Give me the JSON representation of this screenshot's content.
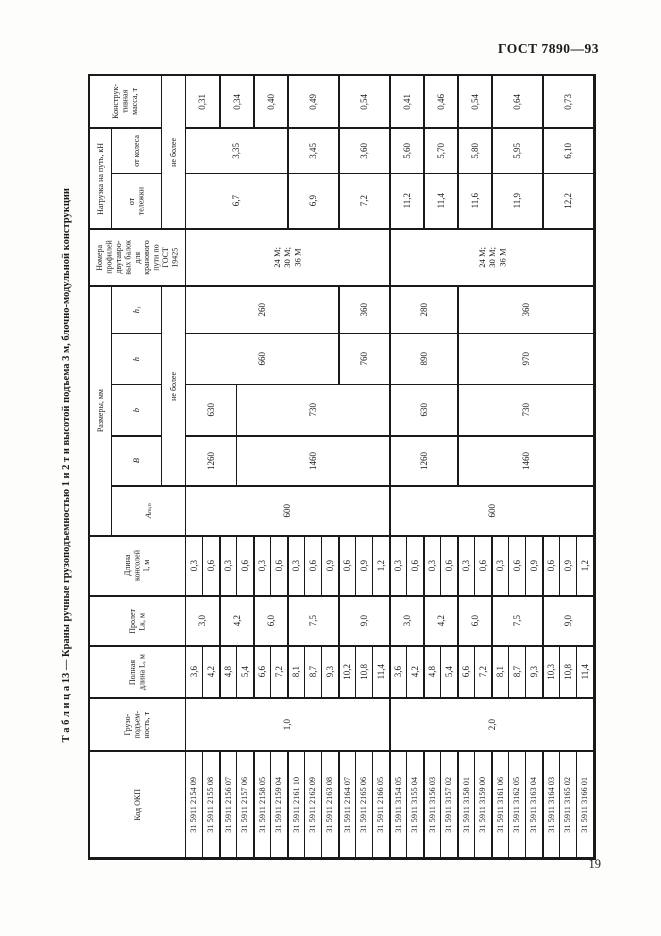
{
  "page": {
    "header": "ГОСТ 7890—93",
    "page_number": "19",
    "table_title": "Т а б л и ц а  13 — Краны ручные грузоподъемностью 1 и 2 т и высотой подъема 3 м, блочно-модульной конструкции"
  },
  "table": {
    "thick_bottom_rows": [
      1,
      3,
      4,
      7,
      8,
      9,
      10,
      11,
      12,
      13
    ],
    "thick_left_cols": [
      6,
      8,
      10,
      13,
      16,
      18,
      20,
      22,
      25
    ],
    "header_cells": [
      {
        "r": 1,
        "c": 1,
        "cs": 2,
        "t": "Конструк-\nтивная\nмасса, т",
        "n": "header-mass",
        "cls": "hdr"
      },
      {
        "r": 1,
        "c": 3,
        "rs": 3,
        "t": "не более",
        "n": "header-ne-bolee-load",
        "cls": "hdr"
      },
      {
        "r": 2,
        "c": 1,
        "rs": 2,
        "t": "Нагрузка на путь, кН",
        "n": "header-load-on-track",
        "cls": "hdr"
      },
      {
        "r": 2,
        "c": 2,
        "t": "от колеса",
        "n": "header-from-wheel",
        "cls": "hdr"
      },
      {
        "r": 3,
        "c": 2,
        "t": "от\nтележки",
        "n": "header-from-trolley",
        "cls": "hdr"
      },
      {
        "r": 4,
        "c": 1,
        "cs": 3,
        "t": "Номера\nпрофилей\nдвутавро-\nвых балок\nдля\nкранового\nпути по\nГОСТ\n19425",
        "n": "header-beam-profiles",
        "cls": "hdr"
      },
      {
        "r": 5,
        "c": 1,
        "rs": 5,
        "t": "Размеры, мм",
        "n": "header-dimensions",
        "cls": "hdr"
      },
      {
        "r": 5,
        "c": 2,
        "t": "h₁",
        "n": "header-h1",
        "cls": "it"
      },
      {
        "r": 6,
        "c": 2,
        "t": "h",
        "n": "header-h",
        "cls": "it"
      },
      {
        "r": 7,
        "c": 2,
        "t": "b",
        "n": "header-b",
        "cls": "it"
      },
      {
        "r": 8,
        "c": 2,
        "t": "B",
        "n": "header-B",
        "cls": "it"
      },
      {
        "r": 5,
        "c": 3,
        "rs": 4,
        "t": "не более",
        "n": "header-ne-bolee-dim",
        "cls": "hdr"
      },
      {
        "r": 9,
        "c": 2,
        "cs": 2,
        "t": "Aₘᵢₙ",
        "n": "header-amin",
        "cls": "it"
      },
      {
        "r": 10,
        "c": 1,
        "cs": 3,
        "t": "Длина\nконсолей\nl, м",
        "n": "header-console-length",
        "cls": "hdr"
      },
      {
        "r": 11,
        "c": 1,
        "cs": 3,
        "t": "Пролет\nLк, м",
        "n": "header-span",
        "cls": "hdr"
      },
      {
        "r": 12,
        "c": 1,
        "cs": 3,
        "t": "Полная\nдлина L, м",
        "n": "header-full-length",
        "cls": "hdr"
      },
      {
        "r": 13,
        "c": 1,
        "cs": 3,
        "t": "Грузо-\nподъем-\nность, т",
        "n": "header-capacity",
        "cls": "hdr"
      },
      {
        "r": 14,
        "c": 1,
        "cs": 3,
        "t": "Код ОКП",
        "n": "header-okp-code",
        "cls": "hdr"
      }
    ],
    "merged_cells": [
      {
        "r": 1,
        "c": 4,
        "cs": 2,
        "t": "0,31",
        "n": "mass-value-cell"
      },
      {
        "r": 1,
        "c": 6,
        "cs": 2,
        "t": "0,34",
        "n": "mass-value-cell"
      },
      {
        "r": 1,
        "c": 8,
        "cs": 2,
        "t": "0,40",
        "n": "mass-value-cell"
      },
      {
        "r": 1,
        "c": 10,
        "cs": 3,
        "t": "0,49",
        "n": "mass-value-cell"
      },
      {
        "r": 1,
        "c": 13,
        "cs": 3,
        "t": "0,54",
        "n": "mass-value-cell"
      },
      {
        "r": 1,
        "c": 16,
        "cs": 2,
        "t": "0,41",
        "n": "mass-value-cell"
      },
      {
        "r": 1,
        "c": 18,
        "cs": 2,
        "t": "0,46",
        "n": "mass-value-cell"
      },
      {
        "r": 1,
        "c": 20,
        "cs": 2,
        "t": "0,54",
        "n": "mass-value-cell"
      },
      {
        "r": 1,
        "c": 22,
        "cs": 3,
        "t": "0,64",
        "n": "mass-value-cell"
      },
      {
        "r": 1,
        "c": 25,
        "cs": 3,
        "t": "0,73",
        "n": "mass-value-cell"
      },
      {
        "r": 2,
        "c": 4,
        "cs": 6,
        "t": "3,35",
        "n": "wheel-load-cell"
      },
      {
        "r": 2,
        "c": 10,
        "cs": 3,
        "t": "3,45",
        "n": "wheel-load-cell"
      },
      {
        "r": 2,
        "c": 13,
        "cs": 3,
        "t": "3,60",
        "n": "wheel-load-cell"
      },
      {
        "r": 2,
        "c": 16,
        "cs": 2,
        "t": "5,60",
        "n": "wheel-load-cell"
      },
      {
        "r": 2,
        "c": 18,
        "cs": 2,
        "t": "5,70",
        "n": "wheel-load-cell"
      },
      {
        "r": 2,
        "c": 20,
        "cs": 2,
        "t": "5,80",
        "n": "wheel-load-cell"
      },
      {
        "r": 2,
        "c": 22,
        "cs": 3,
        "t": "5,95",
        "n": "wheel-load-cell"
      },
      {
        "r": 2,
        "c": 25,
        "cs": 3,
        "t": "6,10",
        "n": "wheel-load-cell"
      },
      {
        "r": 3,
        "c": 4,
        "cs": 6,
        "t": "6,7",
        "n": "trolley-load-cell"
      },
      {
        "r": 3,
        "c": 10,
        "cs": 3,
        "t": "6,9",
        "n": "trolley-load-cell"
      },
      {
        "r": 3,
        "c": 13,
        "cs": 3,
        "t": "7,2",
        "n": "trolley-load-cell"
      },
      {
        "r": 3,
        "c": 16,
        "cs": 2,
        "t": "11,2",
        "n": "trolley-load-cell"
      },
      {
        "r": 3,
        "c": 18,
        "cs": 2,
        "t": "11,4",
        "n": "trolley-load-cell"
      },
      {
        "r": 3,
        "c": 20,
        "cs": 2,
        "t": "11,6",
        "n": "trolley-load-cell"
      },
      {
        "r": 3,
        "c": 22,
        "cs": 3,
        "t": "11,9",
        "n": "trolley-load-cell"
      },
      {
        "r": 3,
        "c": 25,
        "cs": 3,
        "t": "12,2",
        "n": "trolley-load-cell"
      },
      {
        "r": 4,
        "c": 4,
        "cs": 12,
        "t": "24 М;\n30 М;\n36 М",
        "n": "profile-numbers-cell",
        "cls": "prof"
      },
      {
        "r": 4,
        "c": 16,
        "cs": 12,
        "t": "24 М;\n30 М;\n36 М",
        "n": "profile-numbers-cell",
        "cls": "prof"
      },
      {
        "r": 5,
        "c": 4,
        "cs": 9,
        "t": "260",
        "n": "h1-value-cell"
      },
      {
        "r": 5,
        "c": 13,
        "cs": 3,
        "t": "360",
        "n": "h1-value-cell"
      },
      {
        "r": 5,
        "c": 16,
        "cs": 4,
        "t": "280",
        "n": "h1-value-cell"
      },
      {
        "r": 5,
        "c": 20,
        "cs": 8,
        "t": "360",
        "n": "h1-value-cell"
      },
      {
        "r": 6,
        "c": 4,
        "cs": 9,
        "t": "660",
        "n": "h-value-cell"
      },
      {
        "r": 6,
        "c": 13,
        "cs": 3,
        "t": "760",
        "n": "h-value-cell"
      },
      {
        "r": 6,
        "c": 16,
        "cs": 4,
        "t": "890",
        "n": "h-value-cell"
      },
      {
        "r": 6,
        "c": 20,
        "cs": 8,
        "t": "970",
        "n": "h-value-cell"
      },
      {
        "r": 7,
        "c": 4,
        "cs": 3,
        "t": "630",
        "n": "b-value-cell"
      },
      {
        "r": 7,
        "c": 7,
        "cs": 9,
        "t": "730",
        "n": "b-value-cell"
      },
      {
        "r": 7,
        "c": 16,
        "cs": 4,
        "t": "630",
        "n": "b-value-cell"
      },
      {
        "r": 7,
        "c": 20,
        "cs": 8,
        "t": "730",
        "n": "b-value-cell"
      },
      {
        "r": 8,
        "c": 4,
        "cs": 3,
        "t": "1260",
        "n": "B-value-cell"
      },
      {
        "r": 8,
        "c": 7,
        "cs": 9,
        "t": "1460",
        "n": "B-value-cell"
      },
      {
        "r": 8,
        "c": 16,
        "cs": 4,
        "t": "1260",
        "n": "B-value-cell"
      },
      {
        "r": 8,
        "c": 20,
        "cs": 8,
        "t": "1460",
        "n": "B-value-cell"
      },
      {
        "r": 9,
        "c": 4,
        "cs": 12,
        "t": "600",
        "n": "amin-value-cell"
      },
      {
        "r": 9,
        "c": 16,
        "cs": 12,
        "t": "600",
        "n": "amin-value-cell"
      },
      {
        "r": 11,
        "c": 4,
        "cs": 2,
        "t": "3,0",
        "n": "span-value-cell"
      },
      {
        "r": 11,
        "c": 6,
        "cs": 2,
        "t": "4,2",
        "n": "span-value-cell"
      },
      {
        "r": 11,
        "c": 8,
        "cs": 2,
        "t": "6,0",
        "n": "span-value-cell"
      },
      {
        "r": 11,
        "c": 10,
        "cs": 3,
        "t": "7,5",
        "n": "span-value-cell"
      },
      {
        "r": 11,
        "c": 13,
        "cs": 3,
        "t": "9,0",
        "n": "span-value-cell"
      },
      {
        "r": 11,
        "c": 16,
        "cs": 2,
        "t": "3,0",
        "n": "span-value-cell"
      },
      {
        "r": 11,
        "c": 18,
        "cs": 2,
        "t": "4,2",
        "n": "span-value-cell"
      },
      {
        "r": 11,
        "c": 20,
        "cs": 2,
        "t": "6,0",
        "n": "span-value-cell"
      },
      {
        "r": 11,
        "c": 22,
        "cs": 3,
        "t": "7,5",
        "n": "span-value-cell"
      },
      {
        "r": 11,
        "c": 25,
        "cs": 3,
        "t": "9,0",
        "n": "span-value-cell"
      },
      {
        "r": 13,
        "c": 4,
        "cs": 12,
        "t": "1,0",
        "n": "capacity-value-cell"
      },
      {
        "r": 13,
        "c": 16,
        "cs": 12,
        "t": "2,0",
        "n": "capacity-value-cell"
      }
    ],
    "simple_rows": [
      {
        "r": 10,
        "n": "console-length-cell",
        "cls": "",
        "values": [
          "0,3",
          "0,6",
          "0,3",
          "0,6",
          "0,3",
          "0,6",
          "0,3",
          "0,6",
          "0,9",
          "0,6",
          "0,9",
          "1,2",
          "0,3",
          "0,6",
          "0,3",
          "0,6",
          "0,3",
          "0,6",
          "0,3",
          "0,6",
          "0,9",
          "0,6",
          "0,9",
          "1,2"
        ]
      },
      {
        "r": 12,
        "n": "full-length-cell",
        "cls": "",
        "values": [
          "3,6",
          "4,2",
          "4,8",
          "5,4",
          "6,6",
          "7,2",
          "8,1",
          "8,7",
          "9,3",
          "10,2",
          "10,8",
          "11,4",
          "3,6",
          "4,2",
          "4,8",
          "5,4",
          "6,6",
          "7,2",
          "8,1",
          "8,7",
          "9,3",
          "10,3",
          "10,8",
          "11,4"
        ]
      },
      {
        "r": 14,
        "n": "okp-code-cell",
        "cls": "code",
        "values": [
          "31 5911 2154 09",
          "31 5911 2155 08",
          "31 5911 2156 07",
          "31 5911 2157 06",
          "31 5911 2158 05",
          "31 5911 2159 04",
          "31 5911 2161 10",
          "31 5911 2162 09",
          "31 5911 2163 08",
          "31 5911 2164 07",
          "31 5911 2165 06",
          "31 5911 2166 05",
          "31 5911 3154 05",
          "31 5911 3155 04",
          "31 5911 3156 03",
          "31 5911 3157 02",
          "31 5911 3158 01",
          "31 5911 3159 00",
          "31 5911 3161 06",
          "31 5911 3162 05",
          "31 5911 3163 04",
          "31 5911 3164 03",
          "31 5911 3165 02",
          "31 5911 3166 01"
        ]
      }
    ]
  }
}
